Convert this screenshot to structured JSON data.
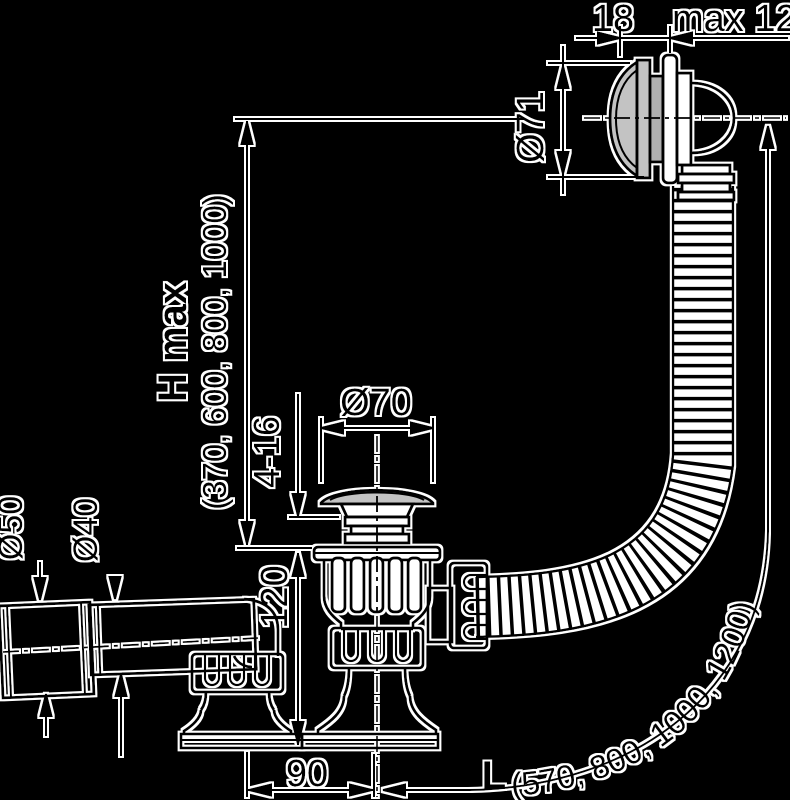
{
  "drawing": {
    "dimensions": {
      "overflow_width": "18",
      "overflow_max_thickness": "max 12",
      "overflow_diameter": "Ø71",
      "height_label": "H max",
      "height_values": "(370, 600, 800, 1000)",
      "plug_diameter": "Ø70",
      "bath_thickness_range": "4-16",
      "socket_diameter": "Ø50",
      "pipe_diameter": "Ø40",
      "drain_height": "120",
      "offset_90": "90",
      "length_label": "L",
      "length_values": "(570, 800, 1000, 1200)"
    },
    "colors": {
      "background": "#000000",
      "line": "#000000",
      "halo": "#ffffff",
      "metal_light": "#c3c3c3",
      "metal_dark": "#b0b0b0"
    }
  }
}
